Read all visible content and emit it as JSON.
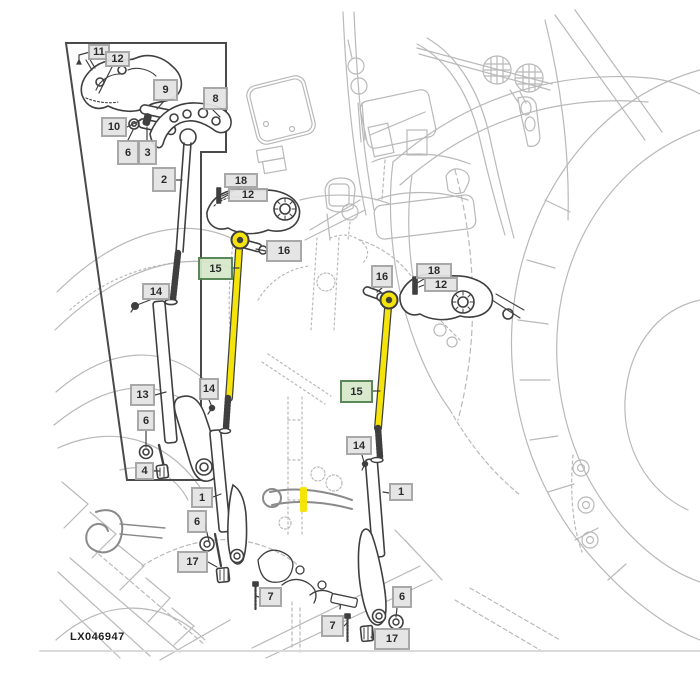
{
  "figure": {
    "kind": "tractor-hitch-lift-link-parts-diagram",
    "part_code": "LX046947",
    "colors": {
      "highlight_yellow": "#f4e40a",
      "green_callout_fill": "#d6e8cb",
      "green_callout_border": "#4e7f4c",
      "callout_fill": "#e4e4e4",
      "callout_border": "#a2a2a2",
      "foreground_line": "#3f3f3f",
      "background_sketch": "#b9b9b9"
    }
  },
  "callouts": [
    {
      "id": "11",
      "label": "11",
      "x": 88,
      "y": 44,
      "w": 22,
      "h": 16
    },
    {
      "id": "12-top",
      "label": "12",
      "x": 105,
      "y": 51,
      "w": 25,
      "h": 16
    },
    {
      "id": "9",
      "label": "9",
      "x": 153,
      "y": 79,
      "w": 25,
      "h": 22
    },
    {
      "id": "8",
      "label": "8",
      "x": 203,
      "y": 87,
      "w": 25,
      "h": 23
    },
    {
      "id": "10",
      "label": "10",
      "x": 101,
      "y": 117,
      "w": 26,
      "h": 20
    },
    {
      "id": "6-inset",
      "label": "6",
      "x": 117,
      "y": 140,
      "w": 22,
      "h": 25
    },
    {
      "id": "3",
      "label": "3",
      "x": 138,
      "y": 140,
      "w": 19,
      "h": 25
    },
    {
      "id": "2",
      "label": "2",
      "x": 152,
      "y": 167,
      "w": 24,
      "h": 25
    },
    {
      "id": "18-left",
      "label": "18",
      "x": 224,
      "y": 173,
      "w": 34,
      "h": 15
    },
    {
      "id": "12-left",
      "label": "12",
      "x": 228,
      "y": 188,
      "w": 40,
      "h": 14
    },
    {
      "id": "16-left",
      "label": "16",
      "x": 266,
      "y": 240,
      "w": 36,
      "h": 22
    },
    {
      "id": "15-left",
      "label": "15",
      "x": 198,
      "y": 257,
      "w": 35,
      "h": 23,
      "variant": "green"
    },
    {
      "id": "14-left",
      "label": "14",
      "x": 142,
      "y": 283,
      "w": 28,
      "h": 17
    },
    {
      "id": "13",
      "label": "13",
      "x": 130,
      "y": 384,
      "w": 25,
      "h": 22
    },
    {
      "id": "6-left",
      "label": "6",
      "x": 137,
      "y": 410,
      "w": 18,
      "h": 21
    },
    {
      "id": "4",
      "label": "4",
      "x": 135,
      "y": 462,
      "w": 19,
      "h": 18
    },
    {
      "id": "14-mid",
      "label": "14",
      "x": 199,
      "y": 378,
      "w": 20,
      "h": 22
    },
    {
      "id": "16-right",
      "label": "16",
      "x": 371,
      "y": 265,
      "w": 22,
      "h": 23
    },
    {
      "id": "18-right",
      "label": "18",
      "x": 416,
      "y": 263,
      "w": 36,
      "h": 16
    },
    {
      "id": "12-right",
      "label": "12",
      "x": 424,
      "y": 277,
      "w": 34,
      "h": 15
    },
    {
      "id": "15-right",
      "label": "15",
      "x": 340,
      "y": 380,
      "w": 33,
      "h": 23,
      "variant": "green"
    },
    {
      "id": "14-right",
      "label": "14",
      "x": 346,
      "y": 436,
      "w": 26,
      "h": 19
    },
    {
      "id": "1-right",
      "label": "1",
      "x": 389,
      "y": 483,
      "w": 24,
      "h": 18
    },
    {
      "id": "1-mid",
      "label": "1",
      "x": 191,
      "y": 487,
      "w": 22,
      "h": 21
    },
    {
      "id": "6-mid",
      "label": "6",
      "x": 187,
      "y": 510,
      "w": 20,
      "h": 23
    },
    {
      "id": "17-mid",
      "label": "17",
      "x": 177,
      "y": 551,
      "w": 31,
      "h": 22
    },
    {
      "id": "7-mid",
      "label": "7",
      "x": 259,
      "y": 587,
      "w": 23,
      "h": 20
    },
    {
      "id": "7-right",
      "label": "7",
      "x": 321,
      "y": 615,
      "w": 23,
      "h": 22
    },
    {
      "id": "6-right",
      "label": "6",
      "x": 392,
      "y": 586,
      "w": 20,
      "h": 22
    },
    {
      "id": "17-right",
      "label": "17",
      "x": 374,
      "y": 628,
      "w": 36,
      "h": 22
    }
  ]
}
